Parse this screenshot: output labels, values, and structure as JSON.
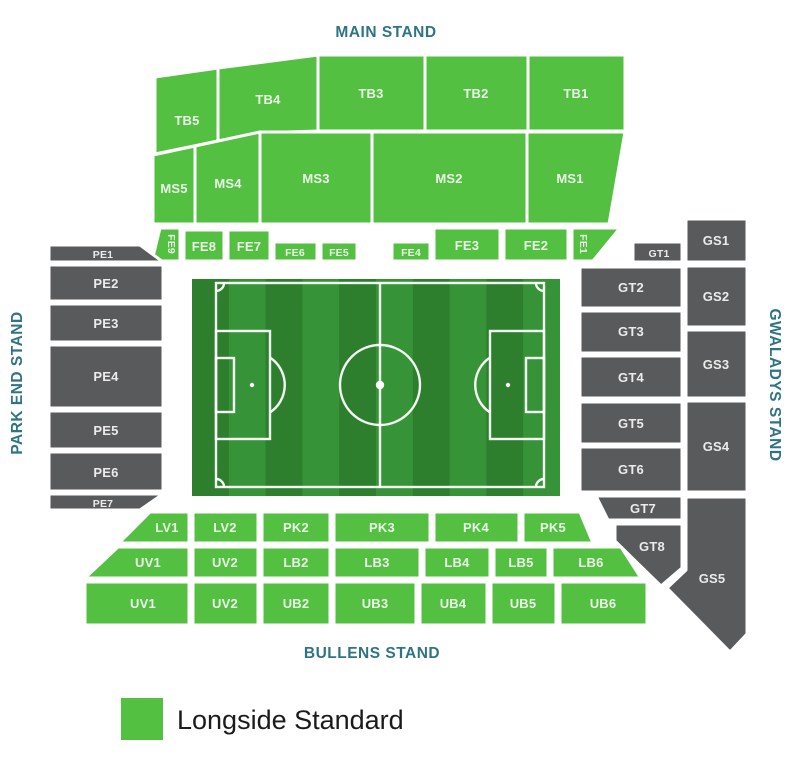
{
  "stands": {
    "main": {
      "title": "MAIN STAND",
      "tb": [
        "TB5",
        "TB4",
        "TB3",
        "TB2",
        "TB1"
      ],
      "ms": [
        "MS5",
        "MS4",
        "MS3",
        "MS2",
        "MS1"
      ],
      "fe": [
        "FE9",
        "FE8",
        "FE7",
        "FE6",
        "FE5",
        "FE4",
        "FE3",
        "FE2",
        "FE1"
      ]
    },
    "park_end": {
      "title": "PARK END STAND",
      "pe": [
        "PE1",
        "PE2",
        "PE3",
        "PE4",
        "PE5",
        "PE6",
        "PE7"
      ]
    },
    "gwaladys": {
      "title": "GWALADYS STAND",
      "gt": [
        "GT1",
        "GT2",
        "GT3",
        "GT4",
        "GT5",
        "GT6",
        "GT7",
        "GT8"
      ],
      "gs": [
        "GS1",
        "GS2",
        "GS3",
        "GS4",
        "GS5"
      ]
    },
    "bullens": {
      "title": "BULLENS STAND",
      "rows": [
        [
          "LV1",
          "LV2",
          "PK2",
          "PK3",
          "PK4",
          "PK5"
        ],
        [
          "UV1",
          "UV2",
          "LB2",
          "LB3",
          "LB4",
          "LB5",
          "LB6"
        ],
        [
          "UV1",
          "UV2",
          "UB2",
          "UB3",
          "UB4",
          "UB5",
          "UB6"
        ]
      ]
    }
  },
  "legend": {
    "label": "Longside Standard",
    "swatch_color": "#53c041"
  },
  "colors": {
    "section_available": "#53c041",
    "section_unavailable": "#595a5c",
    "stand_title": "#2e7484",
    "section_label": "#ffffff",
    "pitch_dark": "#2d7f2d",
    "pitch_light": "#379337",
    "pitch_line": "#ffffff"
  }
}
